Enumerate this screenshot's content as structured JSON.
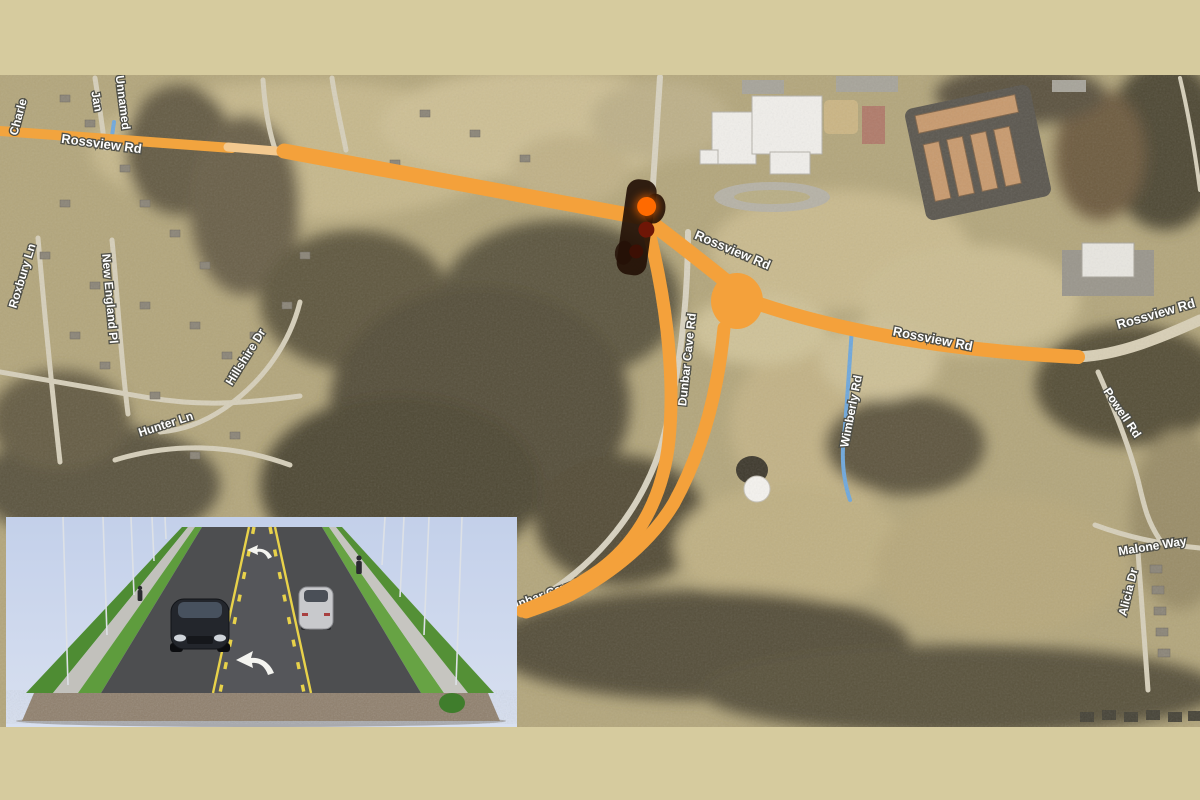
{
  "scene": {
    "title": "Rossview Rd corridor aerial map with proposed road project overlay",
    "type": "presentation-slide-map"
  },
  "colors": {
    "border_tan": "#d6cb9e",
    "annotation_orange": "#f4a13b",
    "annotation_orange_pale": "#f3c98f",
    "stream_blue": "#6fa8dc",
    "signal_lit_orange": "#ff6a00",
    "label_text": "#ffffff",
    "label_outline": "#4e4e46",
    "inset_sky": "#c9d5ec"
  },
  "map": {
    "labels": [
      {
        "id": "charle",
        "text": "Charle"
      },
      {
        "id": "jan",
        "text": "Jan"
      },
      {
        "id": "unnamed",
        "text": "Unnamed"
      },
      {
        "id": "rossview-left",
        "text": "Rossview Rd"
      },
      {
        "id": "roxbury-ln",
        "text": "Roxbury Ln"
      },
      {
        "id": "new-england-pl",
        "text": "New England Pl"
      },
      {
        "id": "hillshire-dr",
        "text": "Hillshire Dr"
      },
      {
        "id": "hunter-ln",
        "text": "Hunter Ln"
      },
      {
        "id": "rossview-center",
        "text": "Rossview Rd"
      },
      {
        "id": "rossview-east",
        "text": "Rossview Rd"
      },
      {
        "id": "rossview-right",
        "text": "Rossview Rd"
      },
      {
        "id": "powell-rd",
        "text": "Powell Rd"
      },
      {
        "id": "wimberly-rd",
        "text": "Wimberly Rd"
      },
      {
        "id": "malone-way",
        "text": "Malone Way"
      },
      {
        "id": "alicia-dr",
        "text": "Alicia Dr"
      },
      {
        "id": "dunbar-cave-sw",
        "text": "Dunbar Cave Rd"
      },
      {
        "id": "dunbar-cave-mid",
        "text": "Dunbar Cave Rd"
      }
    ],
    "annotations": {
      "highlight_route": "Rossview Rd highlighted in orange",
      "proposed_alignments": "two orange curves from Rossview Rd intersection south to Dunbar Cave Rd",
      "node_marker": "large orange dot on Rossview Rd",
      "signal_marker": "traffic-signal icon with lit orange lamp at Rossview Rd intersection"
    }
  },
  "inset": {
    "description": "3D rendering of three-lane roadway with center turn lane, turn arrows, sidewalks, grass strips, light poles, two cars and pedestrians"
  }
}
